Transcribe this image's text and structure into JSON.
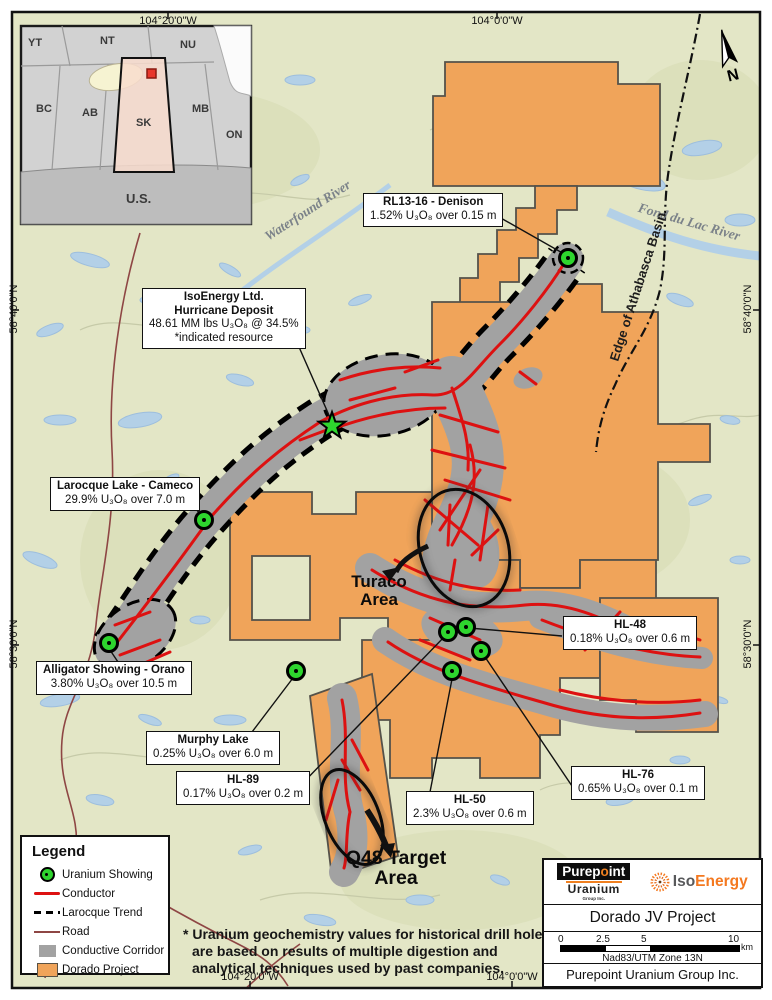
{
  "frame": {
    "top_left": "104°20'0\"W",
    "top_right": "104°0'0\"W",
    "bottom_left": "104°20'0\"W",
    "bottom_right": "104°0'0\"W",
    "left_upper": "58°40'0\"N",
    "left_lower": "58°30'0\"N",
    "right_upper": "58°40'0\"N",
    "right_lower": "58°30'0\"N"
  },
  "north": {
    "label": "N"
  },
  "inset": {
    "yt": "YT",
    "nt": "NT",
    "nu": "NU",
    "bc": "BC",
    "ab": "AB",
    "sk": "SK",
    "mb": "MB",
    "on": "ON",
    "us": "U.S."
  },
  "map_labels": {
    "waterfound": "Waterfound River",
    "fond_du_lac": "Fond du Lac River",
    "basin_edge": "Edge of Athabasca Basin",
    "turaco_1": "Turaco",
    "turaco_2": "Area",
    "q48_1": "Q48 Target",
    "q48_2": "Area"
  },
  "callouts": {
    "rl1316": {
      "title": "RL13-16 - Denison",
      "value": "1.52% U₃O₈ over 0.15 m"
    },
    "hurricane": {
      "line1": "IsoEnergy Ltd.",
      "line2": "Hurricane Deposit",
      "value": "48.61 MM lbs U₃O₈ @ 34.5%",
      "note": "*indicated resource"
    },
    "larocque": {
      "title": "Larocque Lake - Cameco",
      "value": "29.9% U₃O₈ over 7.0 m"
    },
    "alligator": {
      "title": "Alligator Showing - Orano",
      "value": "3.80% U₃O₈ over 10.5 m"
    },
    "murphy": {
      "title": "Murphy Lake",
      "value": "0.25% U₃O₈ over 6.0 m"
    },
    "hl89": {
      "title": "HL-89",
      "value": "0.17% U₃O₈ over 0.2 m"
    },
    "hl48": {
      "title": "HL-48",
      "value": "0.18% U₃O₈ over 0.6 m"
    },
    "hl76": {
      "title": "HL-76",
      "value": "0.65% U₃O₈ over 0.1 m"
    },
    "hl50": {
      "title": "HL-50",
      "value": "2.3% U₃O₈ over 0.6 m"
    }
  },
  "legend": {
    "title": "Legend",
    "items": {
      "showing": "Uranium Showing",
      "conductor": "Conductor",
      "trend": "Larocque Trend",
      "road": "Road",
      "corridor": "Conductive Corridor",
      "dorado": "Dorado Project"
    }
  },
  "footnote": "* Uranium geochemistry values for historical drill holes are based on results of multiple digestion and analytical techniques used by past companies.",
  "panel": {
    "title": "Dorado JV Project",
    "datum": "Nad83/UTM Zone 13N",
    "credit": "Purepoint Uranium Group Inc.",
    "scale": {
      "t0": "0",
      "t1": "2.5",
      "t2": "5",
      "t3": "10",
      "unit": "km"
    },
    "purepoint": {
      "p1": "Purep",
      "p2": "o",
      "p3": "int",
      "name": "Uranium",
      "sub": "Group Inc."
    },
    "isoenergy": {
      "iso": "Iso",
      "energy": "Energy"
    }
  },
  "colors": {
    "dorado": "#f0a45a",
    "corridor": "#a2a2a2",
    "conductor": "#dd1111",
    "showing": "#2ed52e",
    "road": "#8e4644",
    "accent_orange": "#f47920",
    "lake": "#b3d0e7",
    "land": "#e3e6c6"
  }
}
